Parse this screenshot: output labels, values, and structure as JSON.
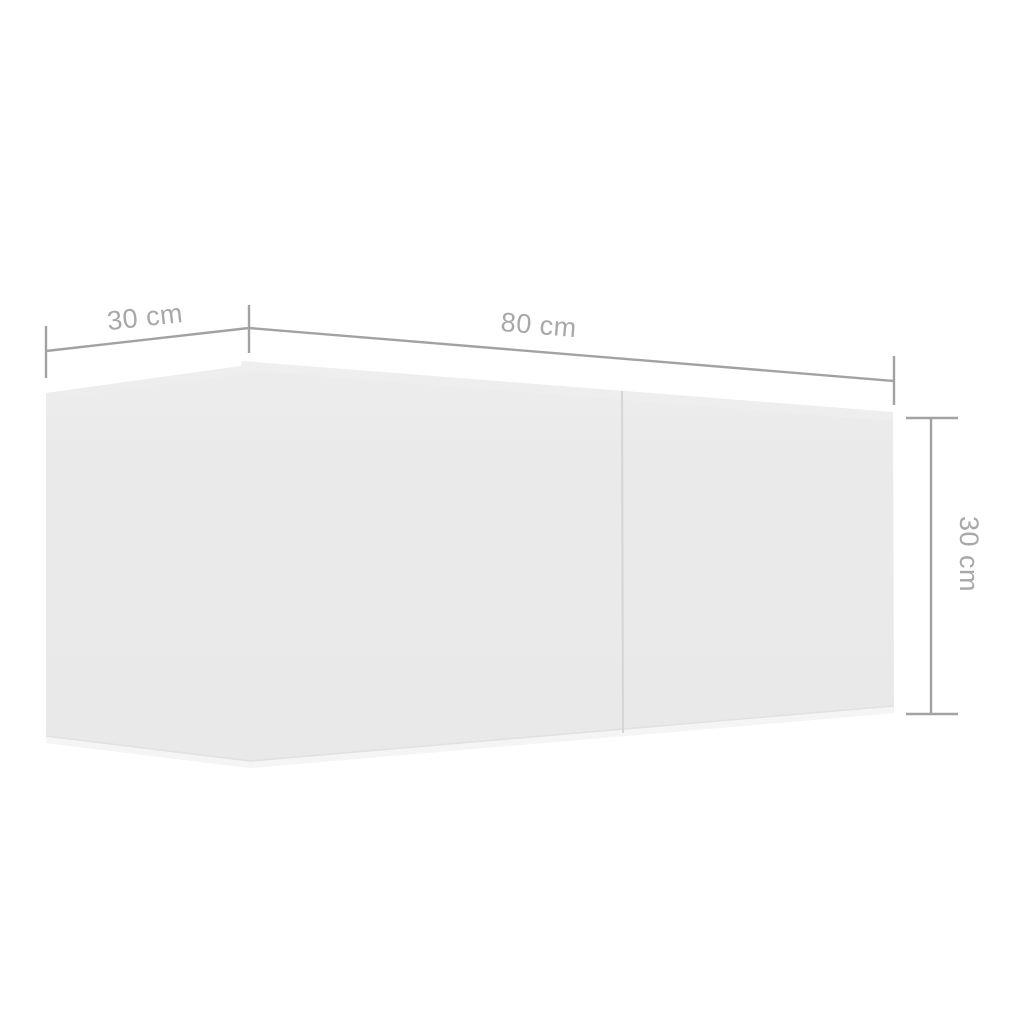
{
  "diagram": {
    "kind": "furniture-dimension-diagram",
    "labels": {
      "depth": "30 cm",
      "width": "80 cm",
      "height": "30 cm"
    }
  },
  "colors": {
    "background": "#ffffff",
    "cabinet_fill": "#eaeaea",
    "cabinet_edge_highlight": "#f6f6f6",
    "cabinet_crease": "#e0e0e0",
    "door_seam": "#d5d5d5",
    "dimension_line": "#a2a2a2",
    "label_text": "#a8a8a8"
  }
}
